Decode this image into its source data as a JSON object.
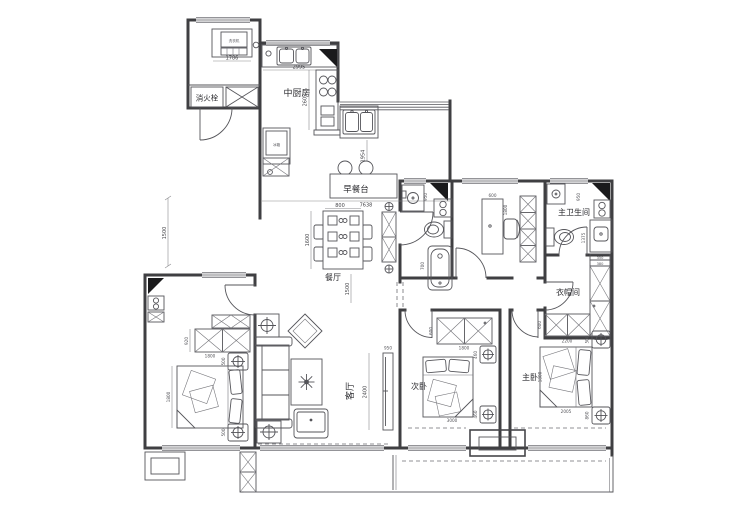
{
  "labels": {
    "fire_hydrant": "消火栓",
    "kitchen": "中厨房",
    "washing_machine": "洗衣机",
    "fridge": "冰箱",
    "breakfast_bar": "早餐台",
    "dining_room": "餐厅",
    "living_room": "客厅",
    "second_bedroom": "次卧",
    "master_bedroom": "主卧",
    "master_bathroom": "主卫生间",
    "cloakroom": "衣帽间"
  },
  "dimensions": {
    "utility_width": "1786",
    "kitchen_counter_width": "2995",
    "kitchen_depth": "2602",
    "west_kitchen_gap": "1954",
    "overall_width": "7638",
    "dining_table_width": "800",
    "dining_table_length": "1600",
    "dining_clearance": "1500",
    "left_offset": "1500",
    "study_desk_width": "600",
    "study_desk_length": "1800",
    "bath_fixture": "950",
    "bath_tub": "700",
    "mbath_fixture": "950",
    "mbath_vanity": "1375",
    "cloak_wardrobe_width": "2200",
    "cloak_wardrobe_depth": "600",
    "cloak_shelf_a": "350",
    "cloak_shelf_b": "380",
    "left_wardrobe_depth": "920",
    "left_wardrobe_width": "1800",
    "left_nightstand_a": "500",
    "left_nightstand_b": "500",
    "left_bed_length": "1800",
    "living_tv_width": "950",
    "living_width": "2400",
    "second_wardrobe_depth": "600",
    "second_wardrobe_width": "1800",
    "second_nightstand_a": "460",
    "second_nightstand_b": "460",
    "second_bed_length": "3000",
    "master_bed_width": "1800",
    "master_bed_length": "2005",
    "master_nightstand_a": "500",
    "master_nightstand_b": "860"
  },
  "colors": {
    "wall_line": "#3f3f42",
    "furniture_line": "#55555a",
    "dimension_text": "#46464a",
    "marker_fill": "#1a1a1c",
    "background": "#ffffff"
  }
}
